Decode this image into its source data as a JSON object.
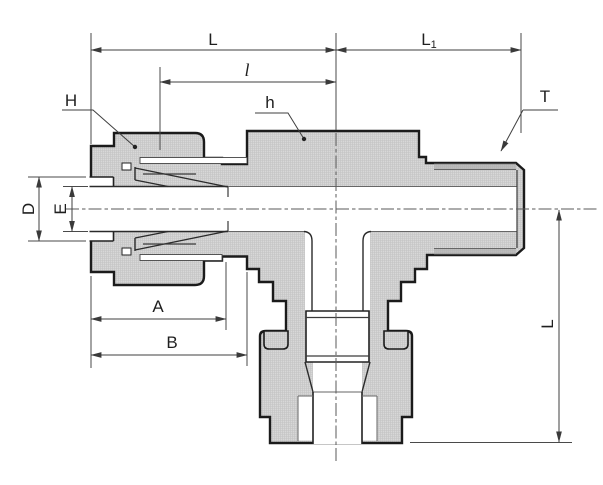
{
  "labels": {
    "length_run": "L",
    "length_right": "L",
    "length_right_sub": "1",
    "length_inner": "l",
    "nut_hex": "H",
    "body_hex": "h",
    "thread": "T",
    "diam_outer": "D",
    "diam_bore": "E",
    "nut_length": "A",
    "to_step": "B",
    "branch_length": "L"
  },
  "colors": {
    "background": "#ffffff",
    "metal": "#d8d8d8",
    "metal_grid": "#c3c3c3",
    "outline": "#1b1b1b",
    "dimension_line": "#3f3f3f",
    "centerline": "#5a5a5a",
    "thread_shade": "#a8a8a8",
    "text": "#1f1f1f"
  }
}
